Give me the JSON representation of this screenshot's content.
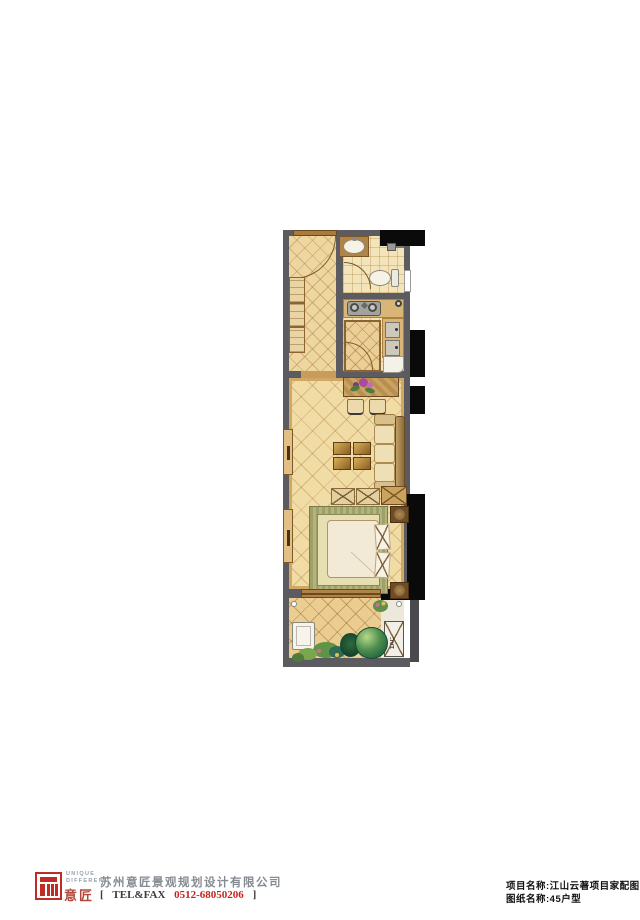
{
  "plan": {
    "ac_label": "1AC"
  },
  "footer": {
    "logo": {
      "unique": "UNIQUE",
      "different": "DIFFERENT",
      "brand": "意匠"
    },
    "company": "苏州意匠景观规划设计有限公司",
    "tel": {
      "open": "[",
      "label": "TEL&FAX",
      "number": "0512-68050206",
      "close": "]"
    },
    "project": {
      "label": "项目名称:",
      "value": "江山云著项目家配图"
    },
    "drawing": {
      "label": "图纸名称:",
      "value": "45户型"
    }
  },
  "colors": {
    "wall": "#5b5b60",
    "floor": "#f0d8a2",
    "wood": "#a87a3e",
    "accent_red": "#c4251d",
    "plant_green": "#4f8f4f",
    "black_shaft": "#0a0a0b"
  }
}
